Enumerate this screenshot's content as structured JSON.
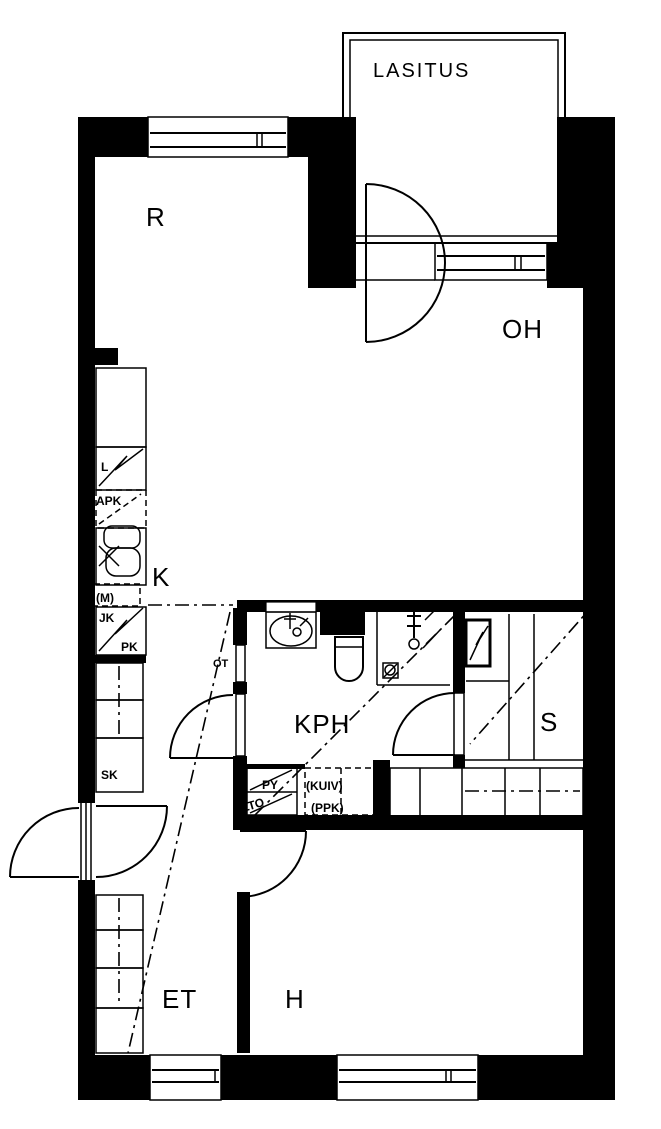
{
  "drawing": {
    "type": "apartment-floor-plan",
    "colors": {
      "line": "#000000",
      "background": "#ffffff"
    }
  },
  "rooms": {
    "glazed_balcony": {
      "label": "LASITUS"
    },
    "alcove": {
      "label": "R"
    },
    "living_room": {
      "label": "OH"
    },
    "kitchen": {
      "label": "K"
    },
    "bathroom": {
      "label": "KPH"
    },
    "sauna": {
      "label": "S"
    },
    "hall": {
      "label": "ET"
    },
    "bedroom": {
      "label": "H"
    }
  },
  "fixtures": {
    "stove": {
      "label": "L"
    },
    "dishwasher": {
      "label": "APK"
    },
    "microwave": {
      "label": "(M)"
    },
    "fridge": {
      "label": "JK"
    },
    "freezer": {
      "label": "PK"
    },
    "cleaning_closet": {
      "label": "SK"
    },
    "hatch": {
      "label": "OT"
    },
    "laundry_cabinet": {
      "label": "PY"
    },
    "heat_recovery_unit": {
      "label": "LTO"
    },
    "dryer": {
      "label": "(KUIV)"
    },
    "washing_machine": {
      "label": "(PPK)"
    }
  }
}
